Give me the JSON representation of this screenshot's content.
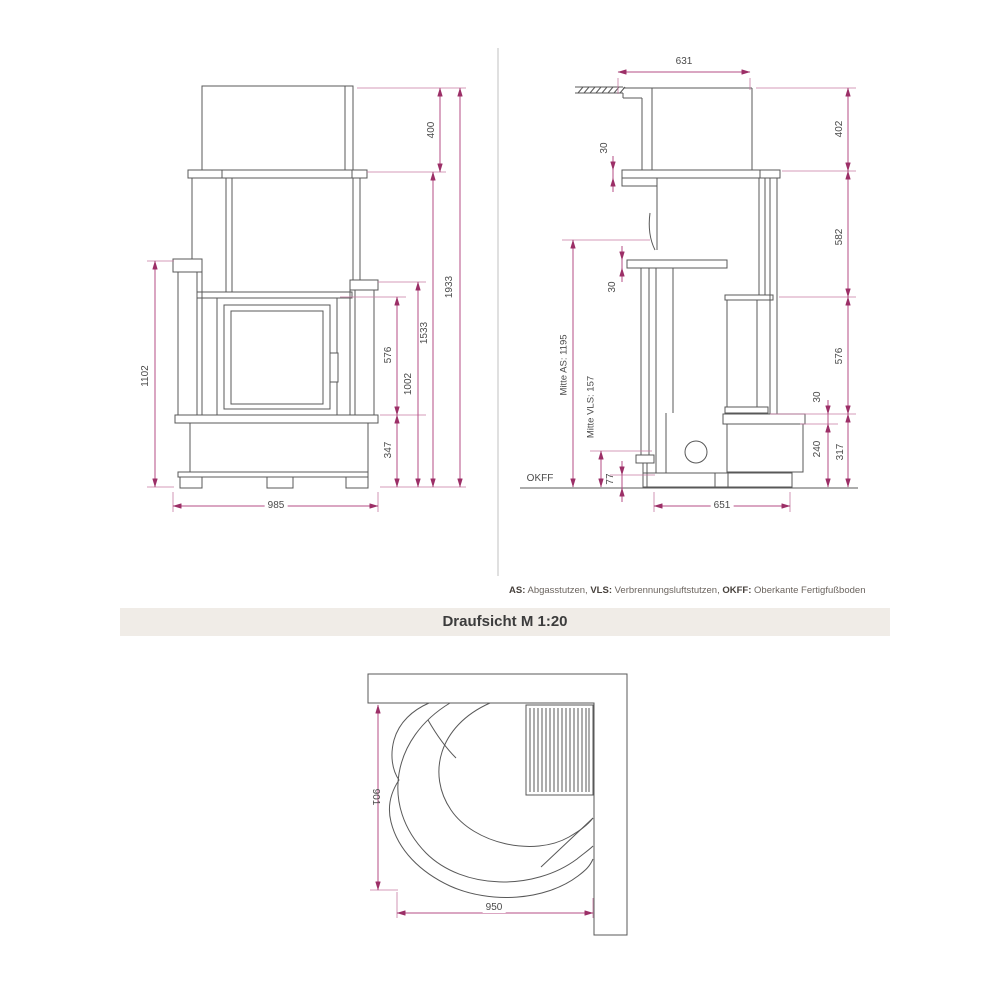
{
  "colors": {
    "dimension_line": "#b64d84",
    "dimension_arrow": "#9c2f67",
    "drawing_line": "#585858",
    "banner_background": "#f0ece7",
    "banner_text": "#3c3c3c",
    "label_text": "#4a4a4a"
  },
  "front_view": {
    "dims": {
      "hood_height": "400",
      "total_height": "1933",
      "upper_height": "1533",
      "left_shelf_height": "1102",
      "window_height": "576",
      "right_shelf_height": "1002",
      "base_height": "347",
      "width": "985"
    }
  },
  "side_view": {
    "dims": {
      "top_depth": "631",
      "hood_depth": "402",
      "mantel_thickness": "30",
      "upper_depth": "582",
      "shelf_thickness": "30",
      "window_height": "576",
      "bench_top_thickness": "30",
      "bench_body_height": "240",
      "bench_height": "317",
      "flue_center": "Mitte AS: 1195",
      "air_center": "Mitte VLS: 157",
      "air_bottom": "77",
      "floor_label": "OKFF",
      "depth": "651"
    }
  },
  "top_view": {
    "dims": {
      "depth": "901",
      "width": "950"
    }
  },
  "legend": {
    "as_label": "AS:",
    "as_text": " Abgasstutzen, ",
    "vls_label": "VLS:",
    "vls_text": " Verbrennungsluftstutzen, ",
    "okff_label": "OKFF:",
    "okff_text": " Oberkante Fertigfußboden"
  },
  "banner": {
    "title": "Draufsicht M 1:20"
  }
}
